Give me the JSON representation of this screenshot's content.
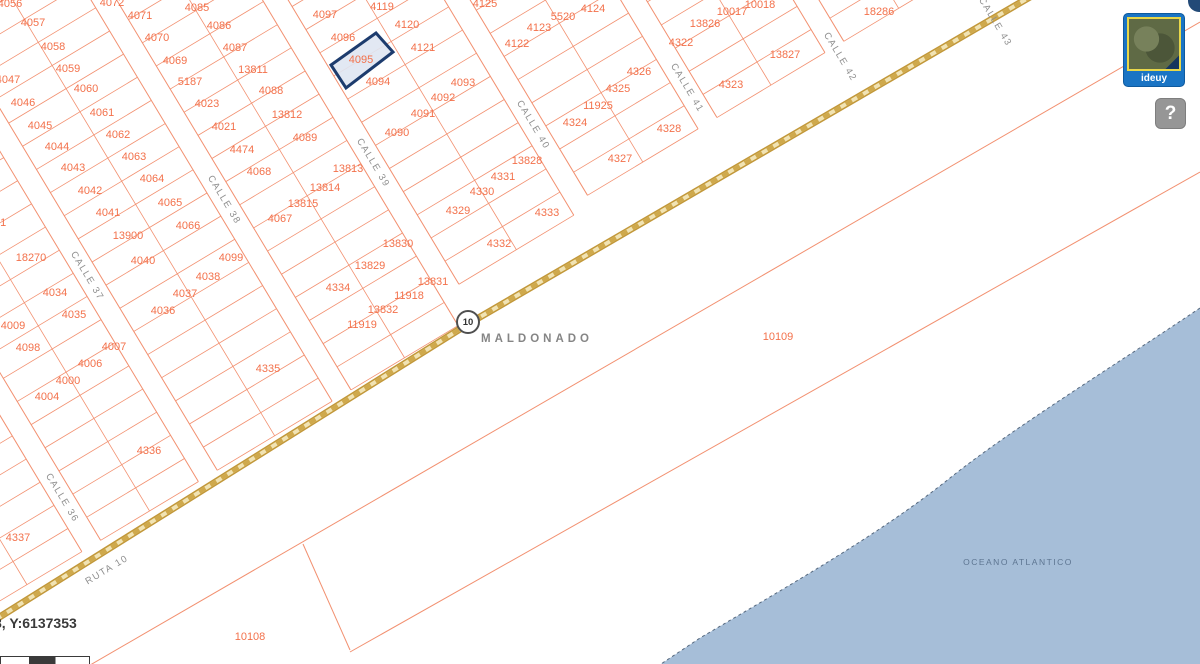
{
  "map": {
    "place_labels": {
      "city": "MALDONADO",
      "ocean": "OCEANO ATLANTICO"
    },
    "route_shield": {
      "n": "10",
      "x": 468,
      "y": 322
    },
    "selected_parcel": {
      "id": "4095",
      "polygon": [
        [
          331,
          65
        ],
        [
          376,
          33
        ],
        [
          393,
          52
        ],
        [
          346,
          88
        ]
      ]
    },
    "street_labels": [
      {
        "n": "CALLE 36",
        "x": 62,
        "y": 498,
        "r": 59
      },
      {
        "n": "CALLE 37",
        "x": 87,
        "y": 276,
        "r": 59
      },
      {
        "n": "CALLE 38",
        "x": 224,
        "y": 200,
        "r": 59
      },
      {
        "n": "CALLE 39",
        "x": 373,
        "y": 163,
        "r": 59
      },
      {
        "n": "CALLE 40",
        "x": 533,
        "y": 125,
        "r": 59
      },
      {
        "n": "CALLE 41",
        "x": 687,
        "y": 88,
        "r": 59
      },
      {
        "n": "CALLE 42",
        "x": 840,
        "y": 57,
        "r": 59
      },
      {
        "n": "CALLE 43",
        "x": 995,
        "y": 22,
        "r": 59
      },
      {
        "n": "RUTA 10",
        "x": 107,
        "y": 570,
        "r": -31
      }
    ],
    "parcel_labels": [
      {
        "n": "4056",
        "x": 10,
        "y": 4
      },
      {
        "n": "4072",
        "x": 112,
        "y": 3
      },
      {
        "n": "4085",
        "x": 197,
        "y": 8
      },
      {
        "n": "4119",
        "x": 382,
        "y": 7
      },
      {
        "n": "4125",
        "x": 485,
        "y": 4
      },
      {
        "n": "4124",
        "x": 593,
        "y": 9
      },
      {
        "n": "10018",
        "x": 760,
        "y": 5
      },
      {
        "n": "10017",
        "x": 732,
        "y": 12
      },
      {
        "n": "18286",
        "x": 879,
        "y": 12
      },
      {
        "n": "4097",
        "x": 325,
        "y": 15
      },
      {
        "n": "5520",
        "x": 563,
        "y": 17
      },
      {
        "n": "4071",
        "x": 140,
        "y": 16
      },
      {
        "n": "4086",
        "x": 219,
        "y": 26
      },
      {
        "n": "4057",
        "x": 33,
        "y": 23
      },
      {
        "n": "4120",
        "x": 407,
        "y": 25
      },
      {
        "n": "13826",
        "x": 705,
        "y": 24
      },
      {
        "n": "4123",
        "x": 539,
        "y": 28
      },
      {
        "n": "4096",
        "x": 343,
        "y": 38
      },
      {
        "n": "4070",
        "x": 157,
        "y": 38
      },
      {
        "n": "4122",
        "x": 517,
        "y": 44
      },
      {
        "n": "4322",
        "x": 681,
        "y": 43
      },
      {
        "n": "4058",
        "x": 53,
        "y": 47
      },
      {
        "n": "4087",
        "x": 235,
        "y": 48
      },
      {
        "n": "4121",
        "x": 423,
        "y": 48
      },
      {
        "n": "13827",
        "x": 785,
        "y": 55
      },
      {
        "n": "4095",
        "x": 361,
        "y": 60
      },
      {
        "n": "4059",
        "x": 68,
        "y": 69
      },
      {
        "n": "4069",
        "x": 175,
        "y": 61
      },
      {
        "n": "13811",
        "x": 253,
        "y": 70
      },
      {
        "n": "4326",
        "x": 639,
        "y": 72
      },
      {
        "n": "4093",
        "x": 463,
        "y": 83
      },
      {
        "n": "4094",
        "x": 378,
        "y": 82
      },
      {
        "n": "5187",
        "x": 190,
        "y": 82
      },
      {
        "n": "4047",
        "x": 8,
        "y": 80
      },
      {
        "n": "4323",
        "x": 731,
        "y": 85
      },
      {
        "n": "4325",
        "x": 618,
        "y": 89
      },
      {
        "n": "4060",
        "x": 86,
        "y": 89
      },
      {
        "n": "4088",
        "x": 271,
        "y": 91
      },
      {
        "n": "4092",
        "x": 443,
        "y": 98
      },
      {
        "n": "4046",
        "x": 23,
        "y": 103
      },
      {
        "n": "4023",
        "x": 207,
        "y": 104
      },
      {
        "n": "11925",
        "x": 598,
        "y": 106
      },
      {
        "n": "4061",
        "x": 102,
        "y": 113
      },
      {
        "n": "4091",
        "x": 423,
        "y": 114
      },
      {
        "n": "13812",
        "x": 287,
        "y": 115
      },
      {
        "n": "4324",
        "x": 575,
        "y": 123
      },
      {
        "n": "4045",
        "x": 40,
        "y": 126
      },
      {
        "n": "4021",
        "x": 224,
        "y": 127
      },
      {
        "n": "4328",
        "x": 669,
        "y": 129
      },
      {
        "n": "4089",
        "x": 305,
        "y": 138
      },
      {
        "n": "4090",
        "x": 397,
        "y": 133
      },
      {
        "n": "4062",
        "x": 118,
        "y": 135
      },
      {
        "n": "4044",
        "x": 57,
        "y": 147
      },
      {
        "n": "4474",
        "x": 242,
        "y": 150
      },
      {
        "n": "4063",
        "x": 134,
        "y": 157
      },
      {
        "n": "4327",
        "x": 620,
        "y": 159
      },
      {
        "n": "13828",
        "x": 527,
        "y": 161
      },
      {
        "n": "13813",
        "x": 348,
        "y": 169
      },
      {
        "n": "4043",
        "x": 73,
        "y": 168
      },
      {
        "n": "4068",
        "x": 259,
        "y": 172
      },
      {
        "n": "4331",
        "x": 503,
        "y": 177
      },
      {
        "n": "4064",
        "x": 152,
        "y": 179
      },
      {
        "n": "13814",
        "x": 325,
        "y": 188
      },
      {
        "n": "4330",
        "x": 482,
        "y": 192
      },
      {
        "n": "4042",
        "x": 90,
        "y": 191
      },
      {
        "n": "4065",
        "x": 170,
        "y": 203
      },
      {
        "n": "13815",
        "x": 303,
        "y": 204
      },
      {
        "n": "4329",
        "x": 458,
        "y": 211
      },
      {
        "n": "4333",
        "x": 547,
        "y": 213
      },
      {
        "n": "4041",
        "x": 108,
        "y": 213
      },
      {
        "n": "4067",
        "x": 280,
        "y": 219
      },
      {
        "n": "4031",
        "x": -6,
        "y": 223
      },
      {
        "n": "4066",
        "x": 188,
        "y": 226
      },
      {
        "n": "13900",
        "x": 128,
        "y": 236
      },
      {
        "n": "13830",
        "x": 398,
        "y": 244
      },
      {
        "n": "4332",
        "x": 499,
        "y": 244
      },
      {
        "n": "18270",
        "x": 31,
        "y": 258
      },
      {
        "n": "4040",
        "x": 143,
        "y": 261
      },
      {
        "n": "4099",
        "x": 231,
        "y": 258
      },
      {
        "n": "13829",
        "x": 370,
        "y": 266
      },
      {
        "n": "4038",
        "x": 208,
        "y": 277
      },
      {
        "n": "13831",
        "x": 433,
        "y": 282
      },
      {
        "n": "4334",
        "x": 338,
        "y": 288
      },
      {
        "n": "4034",
        "x": 55,
        "y": 293
      },
      {
        "n": "4037",
        "x": 185,
        "y": 294
      },
      {
        "n": "11918",
        "x": 409,
        "y": 296
      },
      {
        "n": "13832",
        "x": 383,
        "y": 310
      },
      {
        "n": "4036",
        "x": 163,
        "y": 311
      },
      {
        "n": "4035",
        "x": 74,
        "y": 315
      },
      {
        "n": "11919",
        "x": 362,
        "y": 325
      },
      {
        "n": "4009",
        "x": 13,
        "y": 326
      },
      {
        "n": "10109",
        "x": 778,
        "y": 337
      },
      {
        "n": "4007",
        "x": 114,
        "y": 347
      },
      {
        "n": "4098",
        "x": 28,
        "y": 348
      },
      {
        "n": "4006",
        "x": 90,
        "y": 364
      },
      {
        "n": "4335",
        "x": 268,
        "y": 369
      },
      {
        "n": "4000",
        "x": 68,
        "y": 381
      },
      {
        "n": "4004",
        "x": 47,
        "y": 397
      },
      {
        "n": "4336",
        "x": 149,
        "y": 451
      },
      {
        "n": "4337",
        "x": 18,
        "y": 538
      },
      {
        "n": "10108",
        "x": 250,
        "y": 637
      }
    ]
  },
  "overlay": {
    "thumbnail_label": "ideuy",
    "help_label": "?",
    "coordinates": "8, Y:6137353"
  },
  "colors": {
    "parcel_line": "#f29070",
    "parcel_text": "#f3714b",
    "road_edge": "#c2983a",
    "road_fill": "#f1e3b3",
    "road_dash": "#cfa94c",
    "water": "#a6bed8",
    "coast": "#55687e",
    "highlight_stroke": "#1d3c6e",
    "highlight_fill": "#dfe6f2"
  }
}
